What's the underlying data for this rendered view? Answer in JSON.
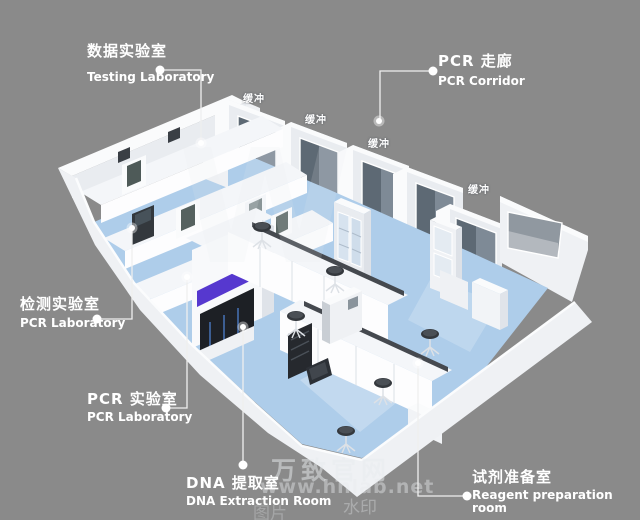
{
  "scene": {
    "width": 640,
    "height": 520,
    "background": "#8a8a8a"
  },
  "callouts": [
    {
      "id": "testing-lab",
      "zh": "数据实验室",
      "en": "Testing Laboratory"
    },
    {
      "id": "pcr-corridor",
      "zh": "PCR 走廊",
      "en": "PCR Corridor"
    },
    {
      "id": "detection-lab",
      "zh": "检测实验室",
      "en": "PCR Laboratory"
    },
    {
      "id": "pcr-lab",
      "zh": "PCR 实验室",
      "en": "PCR Laboratory"
    },
    {
      "id": "dna-extraction",
      "zh": "DNA 提取室",
      "en": "DNA Extraction Room"
    },
    {
      "id": "reagent-prep",
      "zh": "试剂准备室",
      "en": "Reagent preparation room"
    }
  ],
  "model": {
    "buffer_room_label": "缓冲"
  },
  "watermark": {
    "big_letter": "W",
    "brand": "万致官网",
    "url": "www.hnlab.net",
    "stamp_right": "水印",
    "stamp_left": "图片"
  },
  "colors": {
    "background": "#8a8a8a",
    "wall_white": "#eff1f4",
    "floor_blue": "#aecdea",
    "corridor_floor": "#c9dcee",
    "window_glass_dark": "#5d6974",
    "window_glass_light": "#7e8a96",
    "panel_blue": "#cfe0ef",
    "accent_purple": "#5638cf",
    "equipment_dark": "#2a2e33",
    "callout_white": "#ffffff"
  }
}
